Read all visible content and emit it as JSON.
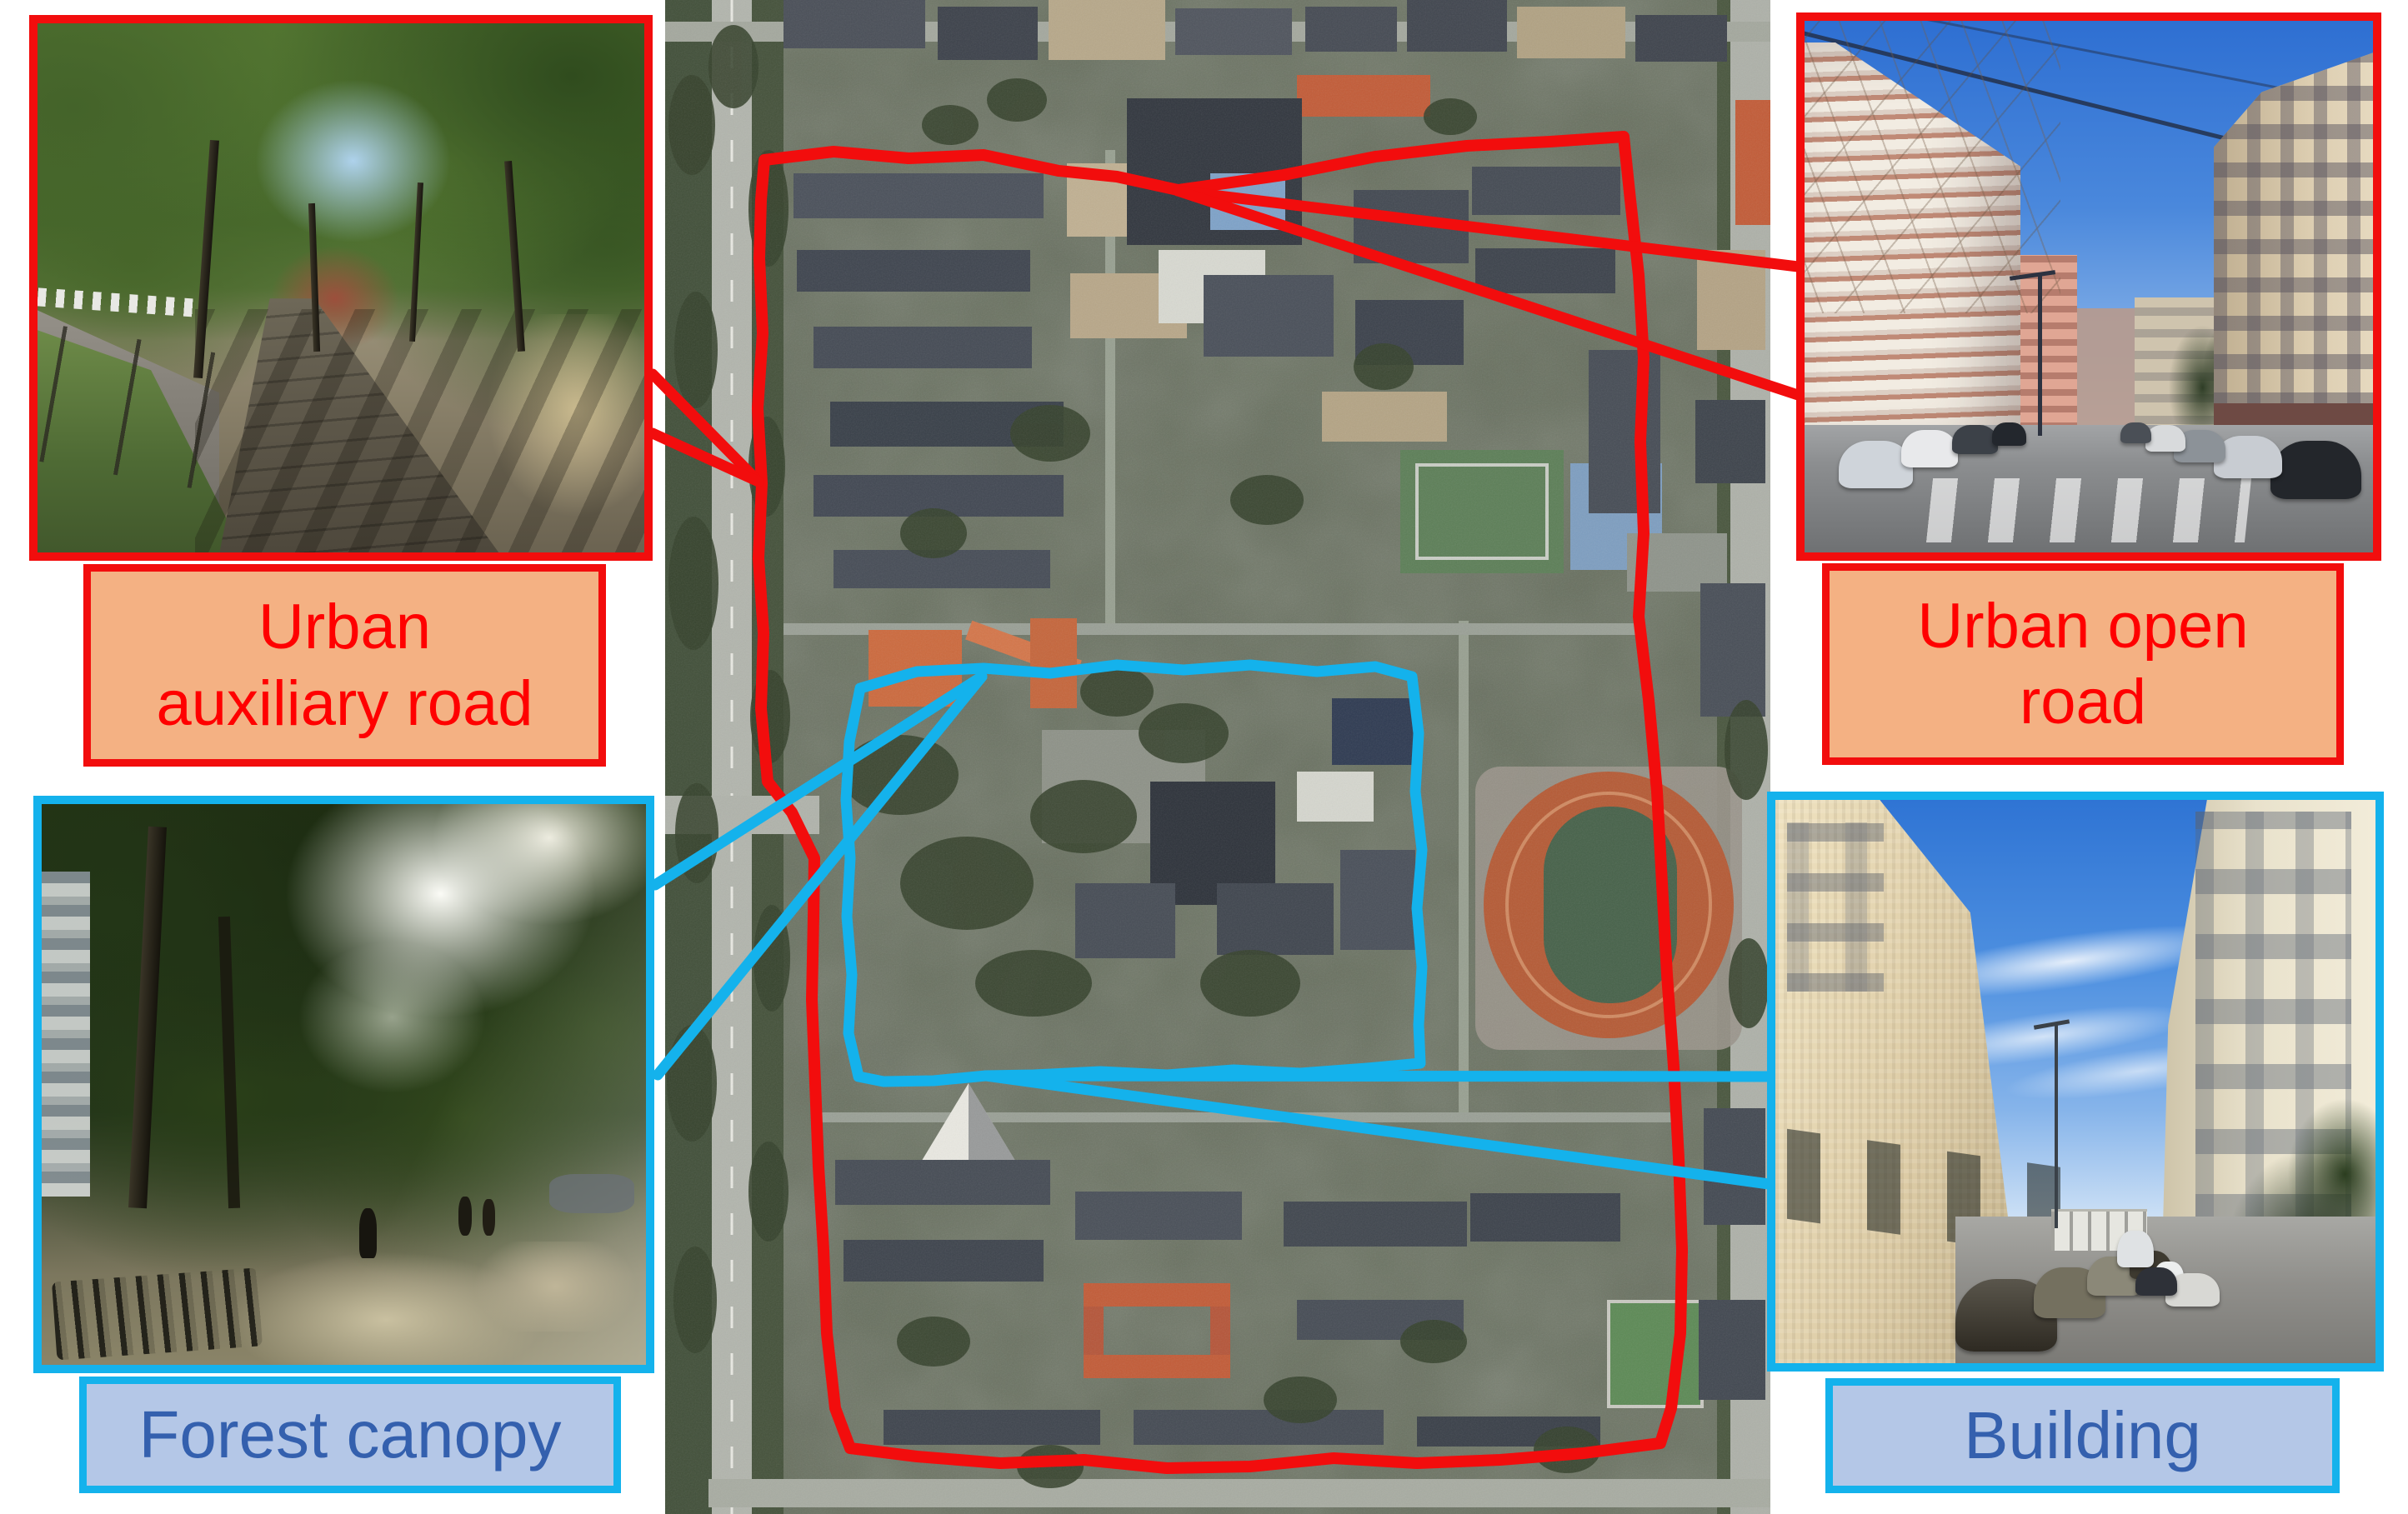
{
  "colors": {
    "red-accent": "#F20D0D",
    "cyan-accent": "#14B2EC",
    "orange-label-bg": "#F4B183",
    "blue-label-bg": "#B4C7E7",
    "red-label-text": "#FF0000",
    "blue-label-text": "#3460AE"
  },
  "callouts": {
    "top_left": {
      "line1": "Urban",
      "line2": "auxiliary road"
    },
    "top_right": {
      "line1": "Urban open",
      "line2": "road"
    },
    "bottom_left": {
      "line1": "Forest canopy"
    },
    "bottom_right": {
      "line1": "Building"
    }
  }
}
